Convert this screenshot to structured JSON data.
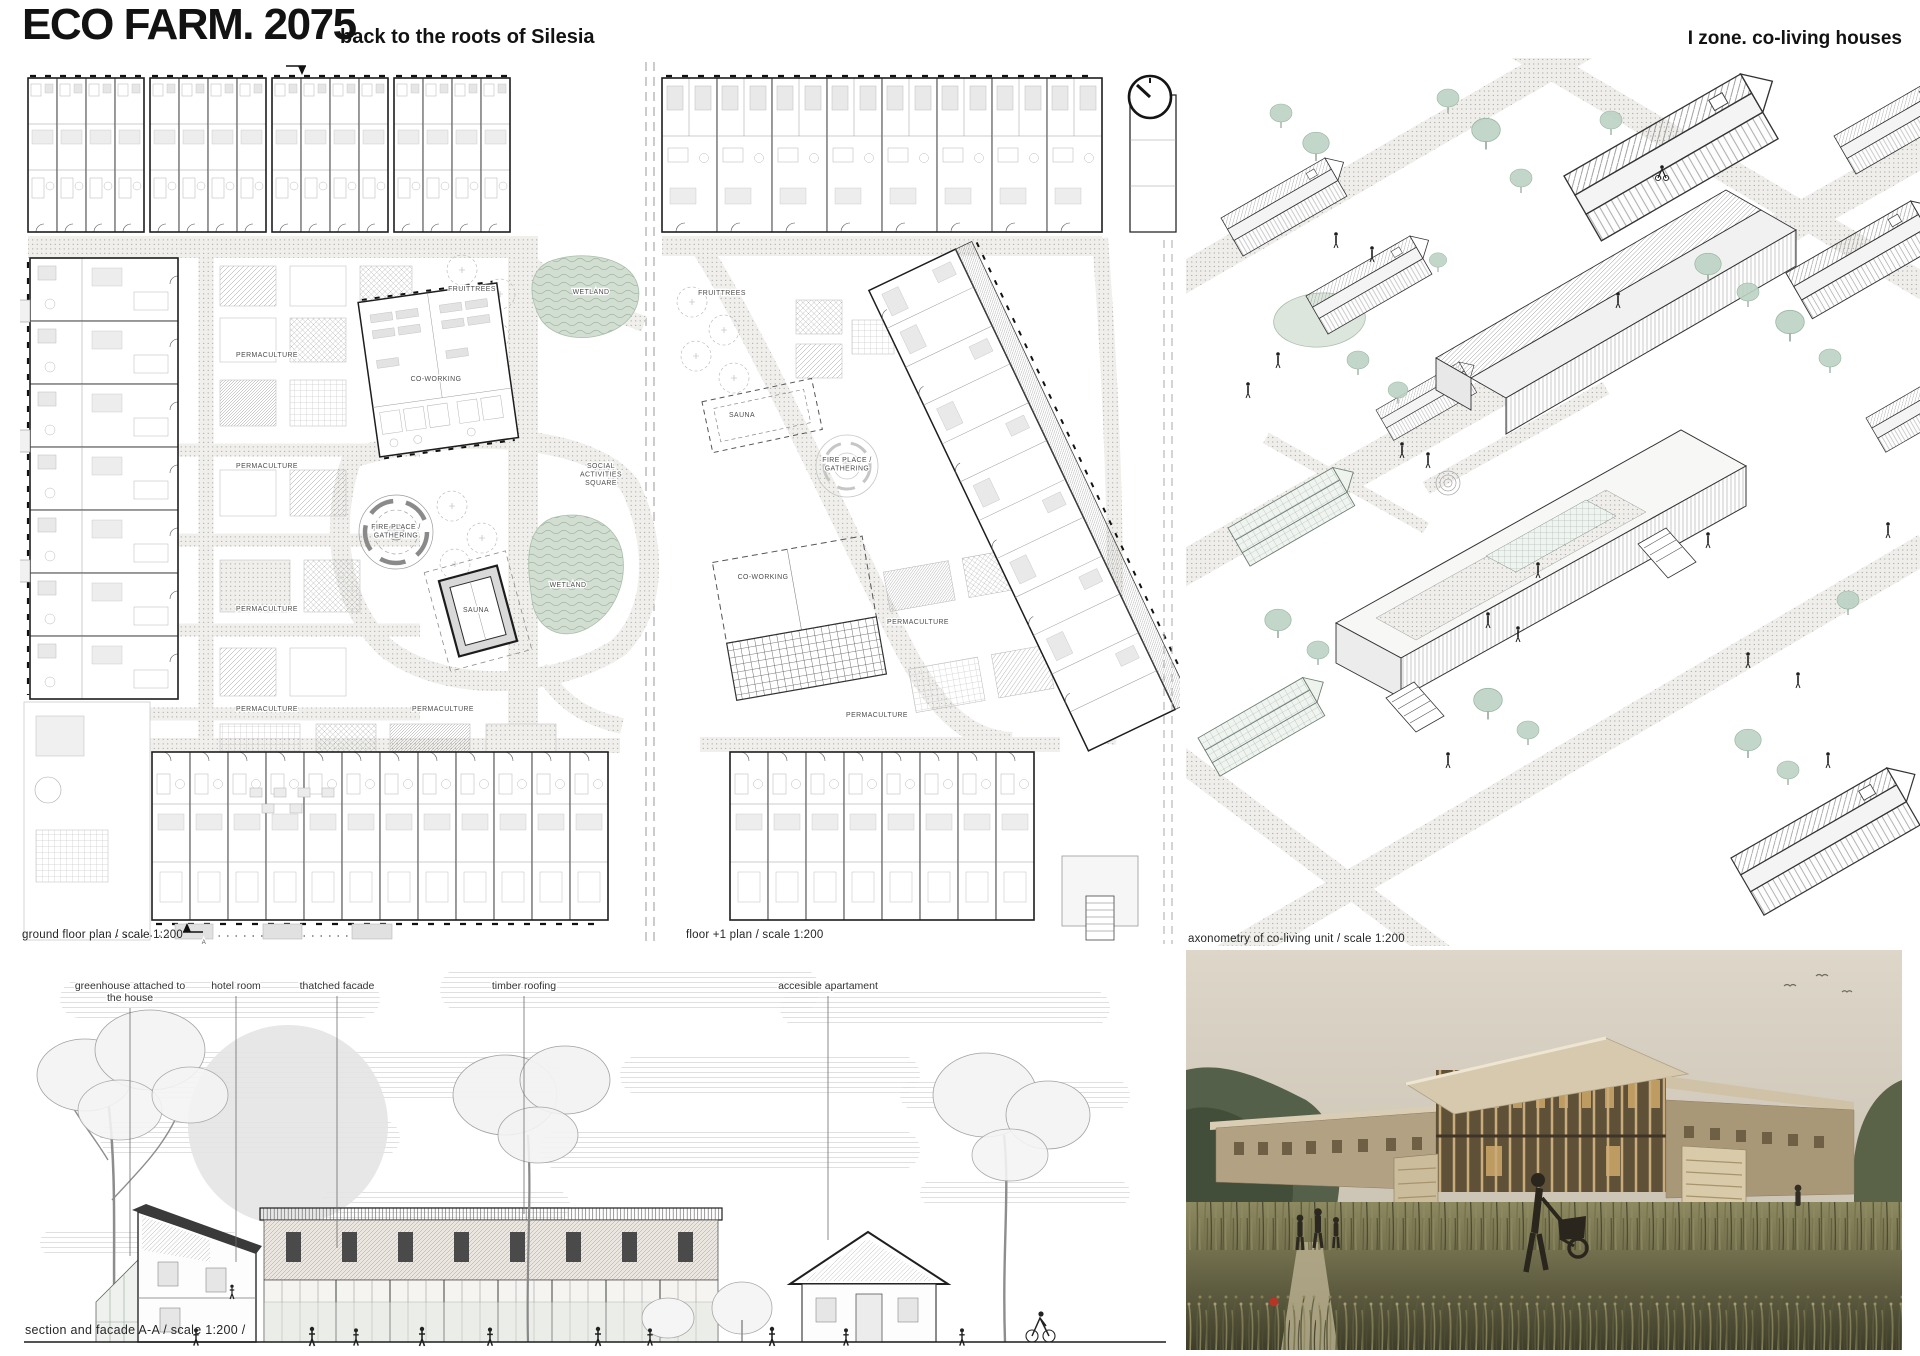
{
  "header": {
    "title": "ECO FARM. 2075",
    "subtitle": "back to the roots of Silesia",
    "zone_label": "I zone. co-living houses"
  },
  "plans": {
    "section_marker": "A",
    "ground": {
      "caption": "ground floor plan / scale 1:200",
      "labels": [
        {
          "text": "FRUITTREES",
          "x": 472,
          "y": 291
        },
        {
          "text": "WETLAND",
          "x": 591,
          "y": 294
        },
        {
          "text": "PERMACULTURE",
          "x": 267,
          "y": 357
        },
        {
          "text": "CO-WORKING",
          "x": 436,
          "y": 381
        },
        {
          "text": "PERMACULTURE",
          "x": 267,
          "y": 468
        },
        {
          "text": "SOCIAL\nACTIVITIES\nSQUARE",
          "x": 601,
          "y": 468
        },
        {
          "text": "FIRE PLACE /\nGATHERING",
          "x": 396,
          "y": 529
        },
        {
          "text": "WETLAND",
          "x": 568,
          "y": 587
        },
        {
          "text": "SAUNA",
          "x": 476,
          "y": 612
        },
        {
          "text": "PERMACULTURE",
          "x": 267,
          "y": 611
        },
        {
          "text": "PERMACULTURE",
          "x": 267,
          "y": 711
        },
        {
          "text": "PERMACULTURE",
          "x": 443,
          "y": 711
        }
      ]
    },
    "upper": {
      "caption": "floor +1 plan / scale 1:200",
      "labels": [
        {
          "text": "FRUITTREES",
          "x": 722,
          "y": 295
        },
        {
          "text": "SAUNA",
          "x": 742,
          "y": 417
        },
        {
          "text": "FIRE PLACE /\nGATHERING",
          "x": 847,
          "y": 462
        },
        {
          "text": "CO-WORKING",
          "x": 763,
          "y": 579
        },
        {
          "text": "PERMACULTURE",
          "x": 918,
          "y": 624
        },
        {
          "text": "PERMACULTURE",
          "x": 877,
          "y": 717
        }
      ]
    }
  },
  "axonometry": {
    "caption": "axonometry of co-living unit / scale 1:200"
  },
  "section": {
    "caption": "section and facade A-A  / scale  1:200 /",
    "annotations": [
      {
        "text": "greenhouse attached to\nthe house",
        "x": 130,
        "y": 989,
        "line_y1": 1008,
        "line_y2": 1256
      },
      {
        "text": "hotel room",
        "x": 236,
        "y": 989,
        "line_y1": 996,
        "line_y2": 1262
      },
      {
        "text": "thatched facade",
        "x": 337,
        "y": 989,
        "line_y1": 996,
        "line_y2": 1248
      },
      {
        "text": "timber roofing",
        "x": 524,
        "y": 989,
        "line_y1": 996,
        "line_y2": 1214
      },
      {
        "text": "accesible apartament",
        "x": 828,
        "y": 989,
        "line_y1": 996,
        "line_y2": 1240
      }
    ]
  },
  "icons": {
    "clock": "clock-icon"
  },
  "colors": {
    "ink": "#1c1c1c",
    "paper": "#ffffff",
    "vegetation": "#b7cdbd",
    "wetland": "#cfdccf",
    "thatch": "#e9e5de",
    "photo_sky": "#d9d2c6",
    "photo_grass": "#6b6a45",
    "poppy": "#b63527"
  }
}
